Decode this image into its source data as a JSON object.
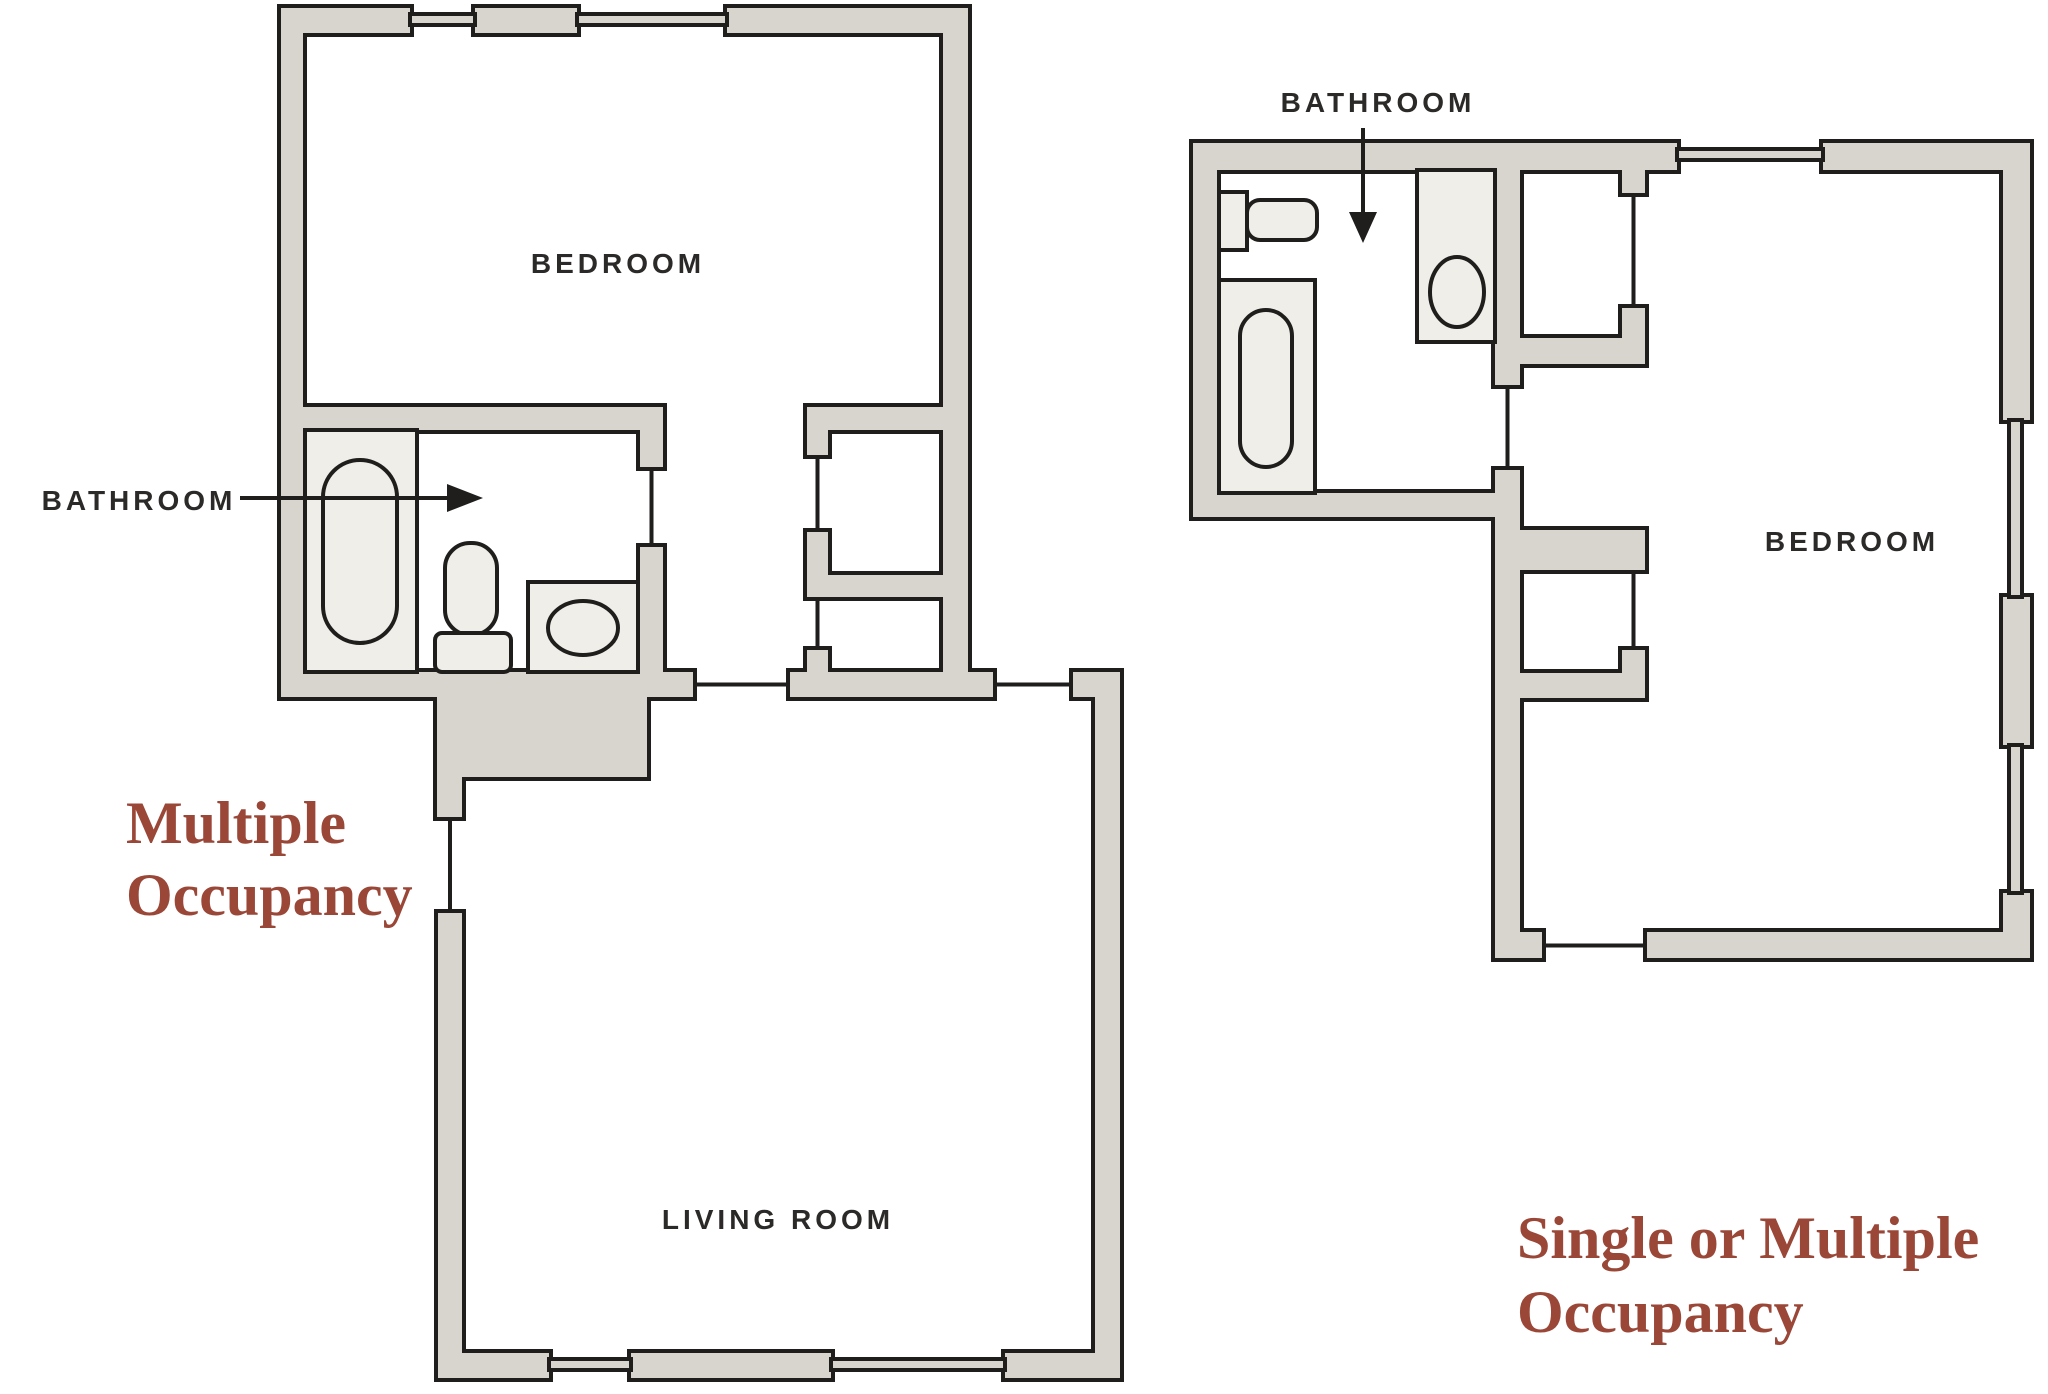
{
  "page": {
    "title": "Floor plans comparing occupancy types",
    "background": "#ffffff"
  },
  "palette": {
    "wall_fill": "#d7d5cd",
    "fixture_fill": "#efeee9",
    "line_color": "#1f1e1c",
    "room_label_color": "#2b2a28",
    "accent_text_color": "#9a4738"
  },
  "icons": {
    "left_bathroom_pointer": "arrow-right-icon",
    "right_bathroom_pointer": "arrow-down-icon"
  },
  "left_plan": {
    "labels": {
      "bedroom": "BEDROOM",
      "bathroom": "BATHROOM",
      "living_room": "LIVING ROOM"
    },
    "occupancy_lines": [
      "Multiple",
      "Occupancy"
    ]
  },
  "right_plan": {
    "labels": {
      "bathroom": "BATHROOM",
      "bedroom": "BEDROOM"
    },
    "occupancy_lines": [
      "Single or Multiple",
      "Occupancy"
    ]
  }
}
